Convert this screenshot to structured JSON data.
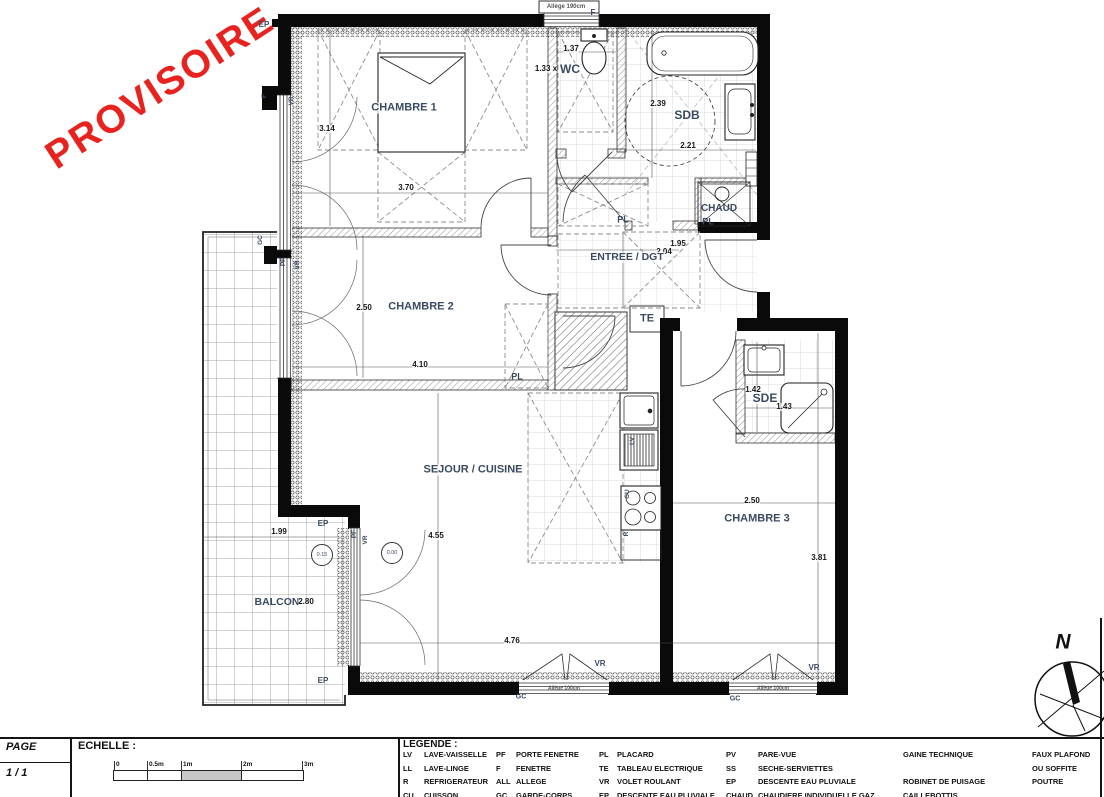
{
  "watermark": "PROVISOIRE",
  "plan": {
    "rooms": {
      "chambre1": "CHAMBRE 1",
      "chambre2": "CHAMBRE 2",
      "chambre3": "CHAMBRE 3",
      "sejour": "SEJOUR / CUISINE",
      "wc": "WC",
      "sdb": "SDB",
      "sde": "SDE",
      "entree": "ENTREE / DGT",
      "balcon": "BALCON",
      "chaud": "CHAUD",
      "te": "TE",
      "pl": "PL"
    },
    "dims": {
      "c1_h": "3.14",
      "c1_w": "3.70",
      "c2_h": "2.50",
      "c2_w": "4.10",
      "c3_w": "2.50",
      "c3_h": "3.81",
      "sej_h": "4.55",
      "sej_w": "4.76",
      "wc_w": "1.37",
      "wc_h": "1.33 x",
      "sdb_h": "2.39",
      "sdb_w": "2.21",
      "ent_w": "1.95",
      "ent_h": "2.04",
      "sde_h": "1.42",
      "sde_w": "1.43",
      "bal_w": "1.99",
      "bal_h": "2.80",
      "lvl_sejour": "0.00",
      "lvl_balcon": "0.15"
    },
    "ann": {
      "ep": "EP",
      "vr": "VR",
      "f": "F",
      "pf": "PF",
      "gc": "GC",
      "lv": "LV",
      "cu": "CU",
      "r": "R",
      "allege190": "Allège 190cm",
      "allege100": "Allège 100cm"
    },
    "north": "N"
  },
  "titleblock": {
    "page_label": "PAGE",
    "page_value": "1 / 1",
    "echelle_label": "ECHELLE :",
    "scale_ticks": [
      "0",
      "0.5m",
      "1m",
      "2m",
      "3m"
    ],
    "legende_label": "LEGENDE :",
    "legend_cols": [
      {
        "rows": [
          [
            "LV",
            "LAVE-VAISSELLE"
          ],
          [
            "LL",
            "LAVE-LINGE"
          ],
          [
            "R",
            "REFRIGERATEUR"
          ],
          [
            "CU",
            "CUISSON"
          ]
        ]
      },
      {
        "rows": [
          [
            "PF",
            "PORTE FENETRE"
          ],
          [
            "F",
            "FENETRE"
          ],
          [
            "ALL",
            "ALLEGE"
          ],
          [
            "GC",
            "GARDE-CORPS"
          ]
        ]
      },
      {
        "rows": [
          [
            "PL",
            "PLACARD"
          ],
          [
            "TE",
            "TABLEAU ELECTRIQUE"
          ],
          [
            "VR",
            "VOLET ROULANT"
          ],
          [
            "EP",
            "DESCENTE EAU PLUVIALE"
          ]
        ]
      },
      {
        "rows": [
          [
            "PV",
            "PARE-VUE"
          ],
          [
            "SS",
            "SECHE-SERVIETTES"
          ],
          [
            "EP",
            "DESCENTE EAU PLUVIALE"
          ],
          [
            "CHAUD",
            "CHAUDIERE INDIVIDUELLE GAZ"
          ]
        ]
      }
    ],
    "legend_text_cols": [
      [
        "GAINE TECHNIQUE",
        "",
        "ROBINET DE PUISAGE",
        "CAILLEBOTTIS"
      ],
      [
        "FAUX PLAFOND",
        "OU SOFFITE",
        "POUTRE",
        ""
      ]
    ]
  }
}
